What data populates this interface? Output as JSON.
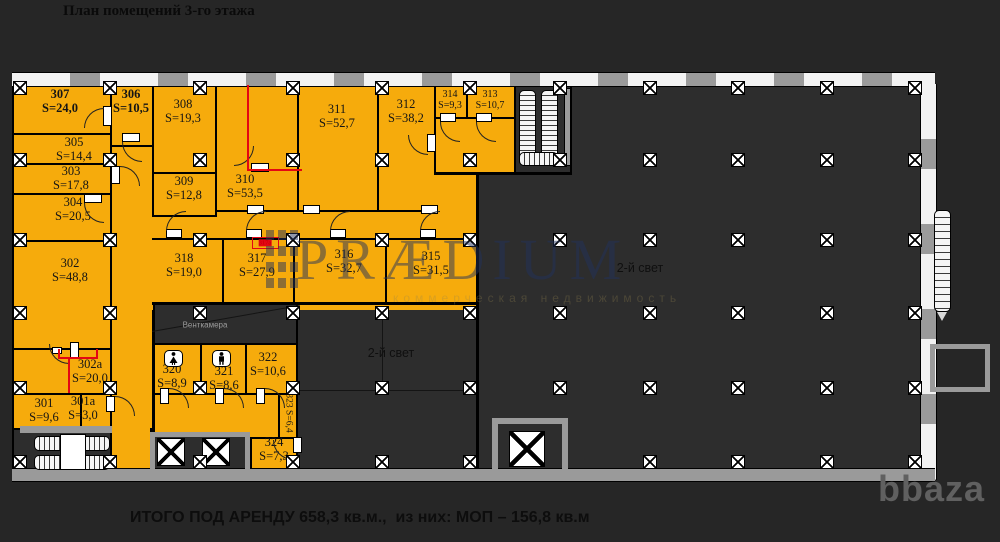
{
  "title": "План помещений 3-го этажа",
  "footer": "ИТОГО ПОД АРЕНДУ 658,3 кв.м.,  из них: МОП – 156,8 кв.м",
  "brand": "bbaza",
  "watermark": {
    "text": "PRÆDIUM",
    "tagline": "коммерческая недвижимость"
  },
  "labels": {
    "second_light": "2-й свет",
    "vent_chamber": "Венткамера"
  },
  "colors": {
    "room_fill": "#F6AB0C",
    "background": "#262626",
    "plan_interior": "#2D2D2D",
    "wall_gray": "#9A9A9A",
    "window_white": "#F2F2F2",
    "marking_red": "#E40613",
    "watermark_blue": "#22325C"
  },
  "rooms": [
    {
      "number": "307",
      "area": "S=24,0"
    },
    {
      "number": "306",
      "area": "S=10,5"
    },
    {
      "number": "308",
      "area": "S=19,3"
    },
    {
      "number": "311",
      "area": "S=52,7"
    },
    {
      "number": "312",
      "area": "S=38,2"
    },
    {
      "number": "314",
      "area": "S=9,3"
    },
    {
      "number": "313",
      "area": "S=10,7"
    },
    {
      "number": "305",
      "area": "S=14,4"
    },
    {
      "number": "303",
      "area": "S=17,8"
    },
    {
      "number": "309",
      "area": "S=12,8"
    },
    {
      "number": "310",
      "area": "S=53,5"
    },
    {
      "number": "304",
      "area": "S=20,5"
    },
    {
      "number": "302",
      "area": "S=48,8"
    },
    {
      "number": "318",
      "area": "S=19,0"
    },
    {
      "number": "317",
      "area": "S=27,9"
    },
    {
      "number": "316",
      "area": "S=32,7"
    },
    {
      "number": "315",
      "area": "S=31,5"
    },
    {
      "number": "317а",
      "area": ""
    },
    {
      "number": "302а",
      "area": "S=20,0"
    },
    {
      "number": "301",
      "area": "S=9,6"
    },
    {
      "number": "301а",
      "area": "S=3,0"
    },
    {
      "number": "320",
      "area": "S=8,9"
    },
    {
      "number": "321",
      "area": "S=8,6"
    },
    {
      "number": "322",
      "area": "S=10,6"
    },
    {
      "number": "323",
      "area": "S=6,4"
    },
    {
      "number": "324",
      "area": "S=7,3"
    }
  ]
}
